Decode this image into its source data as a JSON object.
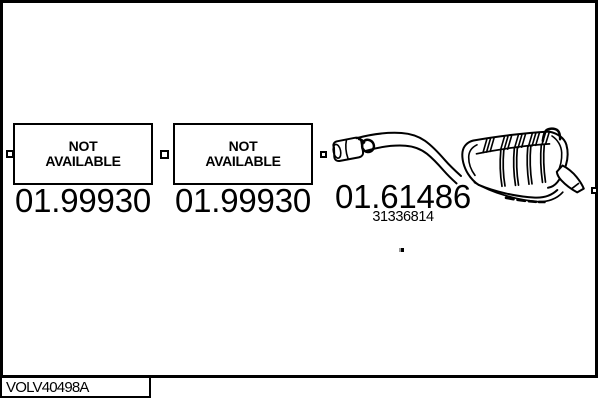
{
  "diagram_code": "VOLV40498A",
  "colors": {
    "line": "#000000",
    "background": "#ffffff"
  },
  "parts": [
    {
      "availability_line1": "NOT",
      "availability_line2": "AVAILABLE",
      "part_number": "01.99930"
    },
    {
      "availability_line1": "NOT",
      "availability_line2": "AVAILABLE",
      "part_number": "01.99930"
    },
    {
      "part_number": "01.61486",
      "oem_number": "31336814",
      "illustration": "rear-exhaust-silencer"
    }
  ]
}
